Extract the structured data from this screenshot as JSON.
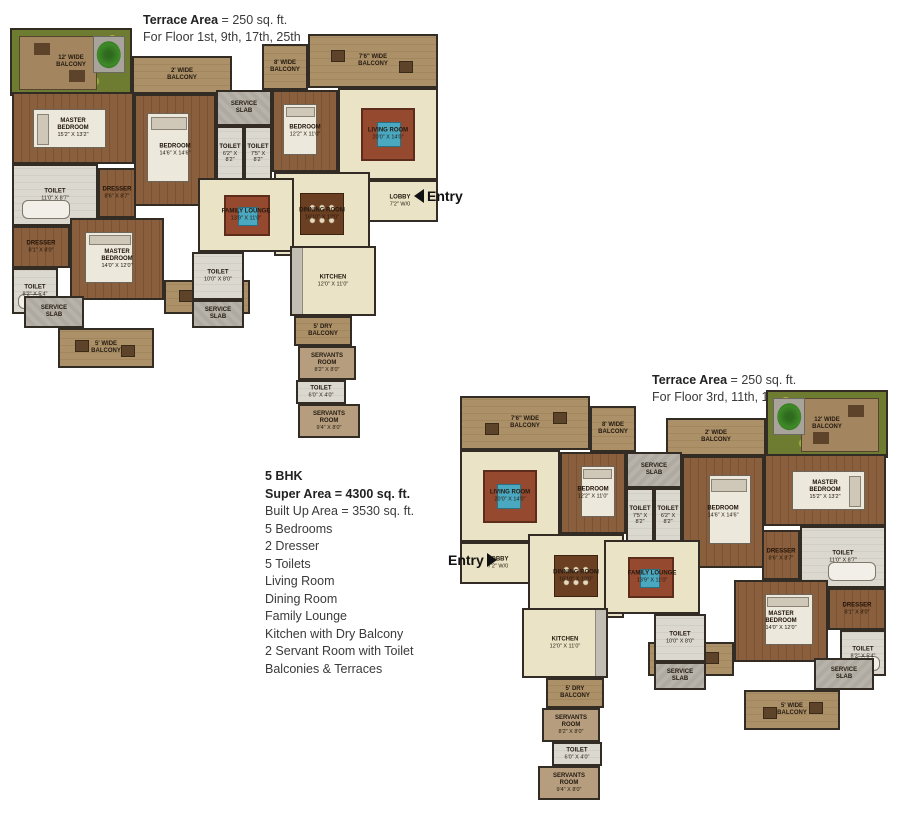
{
  "annotations": {
    "terrace_note_1": {
      "label": "Terrace Area",
      "value": "= 250 sq. ft.",
      "floors": "For Floor 1st, 9th, 17th, 25th"
    },
    "terrace_note_2": {
      "label": "Terrace Area",
      "value": "= 250 sq. ft.",
      "floors": "For Floor 3rd, 11th, 19th"
    },
    "entry_1": "Entry",
    "entry_2": "Entry"
  },
  "specs": {
    "title": "5 BHK",
    "super_area": "Super Area = 4300 sq. ft.",
    "details": [
      "Built Up Area = 3530 sq. ft.",
      "5 Bedrooms",
      "2 Dresser",
      "5 Toilets",
      "Living Room",
      "Dining Room",
      "Family Lounge",
      "Kitchen with Dry Balcony",
      "2 Servant Room with Toilet",
      "Balconies & Terraces"
    ]
  },
  "colors": {
    "wall": "#332c24",
    "wood_floor": "#8a5f3d",
    "living_floor": "#ebe3c6",
    "toilet_floor": "#d9d6ce",
    "service_slab": "#b5b2a9",
    "deck": "#a3865f",
    "foliage": "#6d7c31",
    "rug_red": "#95492f",
    "rug_blue": "#4aa8c0"
  },
  "plans": [
    {
      "id": "plan-1",
      "mirrored": false
    },
    {
      "id": "plan-2",
      "mirrored": true
    }
  ],
  "rooms": [
    {
      "n": "terrace-12ft-balcony",
      "label": "12' WIDE\nBALCONY",
      "t": "terrace",
      "x": 0,
      "y": 0,
      "w": 122,
      "h": 68,
      "f": "deck",
      "tree": true
    },
    {
      "n": "balcony-2ft",
      "label": "2' WIDE\nBALCONY",
      "t": "deck",
      "x": 122,
      "y": 28,
      "w": 100,
      "h": 38
    },
    {
      "n": "balcony-8ft",
      "label": "8' WIDE\nBALCONY",
      "t": "deck",
      "x": 252,
      "y": 16,
      "w": 46,
      "h": 46
    },
    {
      "n": "balcony-7ft6",
      "label": "7'6\" WIDE\nBALCONY",
      "t": "deck",
      "x": 298,
      "y": 6,
      "w": 130,
      "h": 54,
      "f": "seats"
    },
    {
      "n": "master-bedroom-1",
      "label": "MASTER\nBEDROOM",
      "dims": "15'2\" X 13'2\"",
      "t": "wood",
      "x": 2,
      "y": 64,
      "w": 122,
      "h": 72,
      "f": "bed-h"
    },
    {
      "n": "bedroom-1",
      "label": "BEDROOM",
      "dims": "14'6\" X 14'6\"",
      "t": "wood",
      "x": 124,
      "y": 66,
      "w": 82,
      "h": 112,
      "f": "bed-v"
    },
    {
      "n": "service-slab-1",
      "label": "SERVICE\nSLAB",
      "t": "slab",
      "x": 206,
      "y": 62,
      "w": 56,
      "h": 36
    },
    {
      "n": "toilet-1",
      "label": "TOILET",
      "dims": "6'2\" X 8'2\"",
      "t": "toilet",
      "x": 206,
      "y": 98,
      "w": 28,
      "h": 56
    },
    {
      "n": "toilet-2",
      "label": "TOILET",
      "dims": "7'5\" X 8'2\"",
      "t": "toilet",
      "x": 234,
      "y": 98,
      "w": 28,
      "h": 56
    },
    {
      "n": "bedroom-2",
      "label": "BEDROOM",
      "dims": "12'2\" X 11'0\"",
      "t": "wood",
      "x": 262,
      "y": 62,
      "w": 66,
      "h": 82,
      "f": "bed-v"
    },
    {
      "n": "living-room",
      "label": "LIVING ROOM",
      "dims": "20'0\" X 14'0\"",
      "t": "beige",
      "x": 328,
      "y": 60,
      "w": 100,
      "h": 92,
      "f": "rug"
    },
    {
      "n": "hallway",
      "t": "beige",
      "x": 318,
      "y": 152,
      "w": 40,
      "h": 74
    },
    {
      "n": "lobby",
      "label": "LOBBY",
      "dims": "7'2\" W/0",
      "t": "beige",
      "x": 352,
      "y": 152,
      "w": 76,
      "h": 42
    },
    {
      "n": "dining-room",
      "label": "DINNING ROOM",
      "dims": "16'10\" X 12'0\"",
      "t": "beige",
      "x": 264,
      "y": 144,
      "w": 96,
      "h": 84,
      "f": "table"
    },
    {
      "n": "family-lounge",
      "label": "FAMILY LOUNGE",
      "dims": "13'9\" X 11'0\"",
      "t": "beige",
      "x": 188,
      "y": 150,
      "w": 96,
      "h": 74,
      "f": "rug2"
    },
    {
      "n": "toilet-3",
      "label": "TOILET",
      "dims": "11'0\" X 8'7\"",
      "t": "toilet",
      "x": 2,
      "y": 136,
      "w": 86,
      "h": 62,
      "f": "tub"
    },
    {
      "n": "dresser-1",
      "label": "DRESSER",
      "dims": "8'6\" X 8'7\"",
      "t": "wood",
      "x": 88,
      "y": 140,
      "w": 38,
      "h": 50
    },
    {
      "n": "master-bedroom-2",
      "label": "MASTER\nBEDROOM",
      "dims": "14'0\" X 12'0\"",
      "t": "wood",
      "x": 60,
      "y": 190,
      "w": 94,
      "h": 82,
      "f": "bed-v"
    },
    {
      "n": "dresser-2",
      "label": "DRESSER",
      "dims": "8'1\" X 8'0\"",
      "t": "wood",
      "x": 2,
      "y": 198,
      "w": 58,
      "h": 42
    },
    {
      "n": "toilet-4",
      "label": "TOILET",
      "dims": "8'2\" X 5'4\"",
      "t": "toilet",
      "x": 2,
      "y": 240,
      "w": 46,
      "h": 46,
      "f": "tub"
    },
    {
      "n": "service-slab-2",
      "label": "SERVICE\nSLAB",
      "t": "slab",
      "x": 14,
      "y": 268,
      "w": 60,
      "h": 32
    },
    {
      "n": "balcony-5ft",
      "label": "5' WIDE\nBALCONY",
      "t": "deck",
      "x": 48,
      "y": 300,
      "w": 96,
      "h": 40,
      "f": "seats"
    },
    {
      "n": "balcony-3ft6",
      "label": "3'6\" WIDE\nBALCONY",
      "t": "deck",
      "x": 154,
      "y": 252,
      "w": 86,
      "h": 34,
      "f": "seats"
    },
    {
      "n": "toilet-5",
      "label": "TOILET",
      "dims": "10'0\" X 8'0\"",
      "t": "toilet",
      "x": 182,
      "y": 224,
      "w": 52,
      "h": 48
    },
    {
      "n": "service-slab-3",
      "label": "SERVICE\nSLAB",
      "t": "slab",
      "x": 182,
      "y": 272,
      "w": 52,
      "h": 28
    },
    {
      "n": "kitchen",
      "label": "KITCHEN",
      "dims": "12'0\" X 11'0\"",
      "t": "beige",
      "x": 280,
      "y": 218,
      "w": 86,
      "h": 70,
      "f": "counter"
    },
    {
      "n": "dry-balcony",
      "label": "5' DRY\nBALCONY",
      "t": "deck",
      "x": 284,
      "y": 288,
      "w": 58,
      "h": 30
    },
    {
      "n": "servant-room-1",
      "label": "SERVANTS\nROOM",
      "dims": "8'2\" X 8'0\"",
      "t": "beige2",
      "x": 288,
      "y": 318,
      "w": 58,
      "h": 34
    },
    {
      "n": "toilet-6",
      "label": "TOILET",
      "dims": "6'0\" X 4'0\"",
      "t": "toilet",
      "x": 286,
      "y": 352,
      "w": 50,
      "h": 24
    },
    {
      "n": "servant-room-2",
      "label": "SERVANTS\nROOM",
      "dims": "9'4\" X 8'0\"",
      "t": "beige2",
      "x": 288,
      "y": 376,
      "w": 62,
      "h": 34
    }
  ]
}
